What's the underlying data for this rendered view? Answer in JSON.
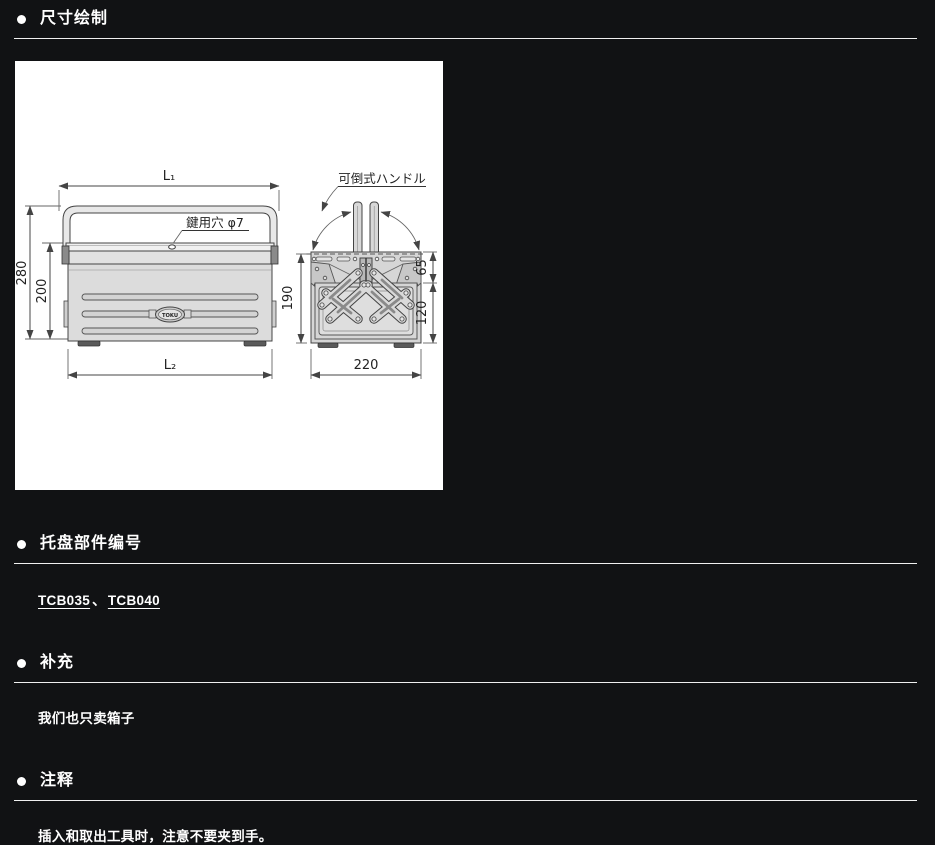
{
  "page": {
    "background": "#111214",
    "text_color": "#ffffff",
    "rule_color": "#f0f0f0"
  },
  "sections": {
    "dimensions": {
      "title": "尺寸绘制"
    },
    "tray": {
      "title": "托盘部件编号",
      "links": [
        {
          "label": "TCB035"
        },
        {
          "label": "TCB040"
        }
      ],
      "separator": "、"
    },
    "supplement": {
      "title": "补充",
      "body": "我们也只卖箱子"
    },
    "notes": {
      "title": "注释",
      "body": "插入和取出工具时，注意不要夹到手。"
    }
  },
  "drawing": {
    "front_view": {
      "width_top": "L₁",
      "width_bottom": "L₂",
      "height_total": "280",
      "height_body": "200",
      "keyhole_label": "鍵用穴 φ7",
      "logo": "TOKU"
    },
    "side_view": {
      "handle_label": "可倒式ハンドル",
      "height": "190",
      "top_section": "65",
      "bottom_section": "120",
      "width": "220"
    }
  }
}
